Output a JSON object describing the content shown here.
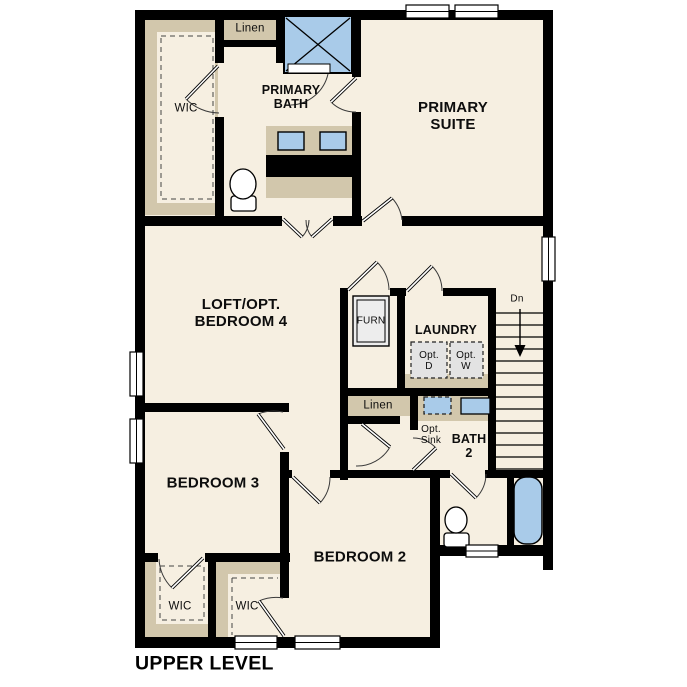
{
  "plan": {
    "title": "UPPER LEVEL",
    "colors": {
      "wall": "#000000",
      "floor": "#f6efe1",
      "closet_tan": "#d2c7ac",
      "fixture_blue": "#a9cbe9",
      "optional_gray": "#e3e3e3"
    },
    "rooms": {
      "primary_suite": "PRIMARY\nSUITE",
      "primary_bath": "PRIMARY\nBATH",
      "loft": "LOFT/OPT.\nBEDROOM 4",
      "laundry": "LAUNDRY",
      "bath2": "BATH\n2",
      "bedroom3": "BEDROOM 3",
      "bedroom2": "BEDROOM 2"
    },
    "closets": {
      "wic_primary": "WIC",
      "wic_bedroom3": "WIC",
      "wic_bedroom2": "WIC",
      "linen_top": "Linen",
      "linen_bath": "Linen",
      "linen_hall": "Linen"
    },
    "fixtures": {
      "furnace": "FURN",
      "opt_dryer": "Opt.\nD",
      "opt_washer": "Opt.\nW",
      "opt_sink": "Opt.\nSink"
    },
    "stairs": {
      "direction": "Dn"
    }
  }
}
